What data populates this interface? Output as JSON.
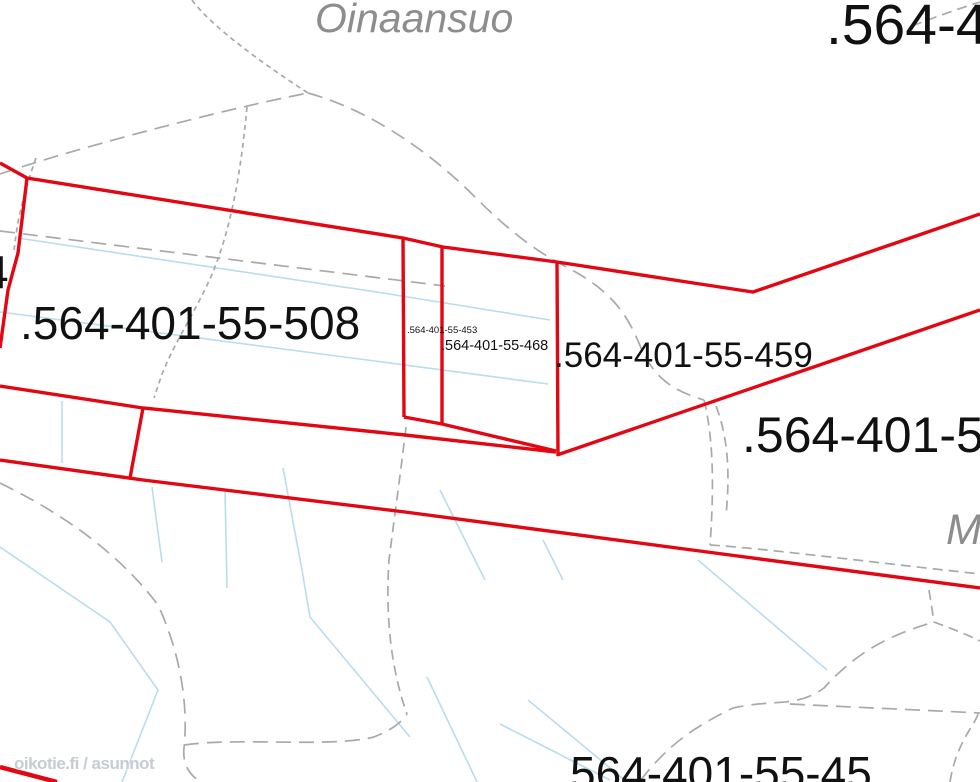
{
  "map": {
    "place_labels": {
      "top": "Oinaansuo",
      "right_edge_partial": "M"
    },
    "parcel_labels": {
      "top_right_partial": ".564-4",
      "left_edge_partial": "4",
      "p508": ".564-401-55-508",
      "p453": ".564-401-55-453",
      "p468": ".564-401-55-468",
      "p459": ".564-401-55-459",
      "right_partial": ".564-401-5",
      "bottom_partial": "564-401-55-45"
    },
    "watermark": "oikotie.fi / asunnot",
    "colors": {
      "boundary_red": "#e30613",
      "contour_gray": "#a9a9a9",
      "ditch_blue": "#b9ddee",
      "label_black": "#111111",
      "place_gray": "#8d8d8d",
      "watermark_gray": "#c6cbd4",
      "background": "#ffffff"
    }
  }
}
